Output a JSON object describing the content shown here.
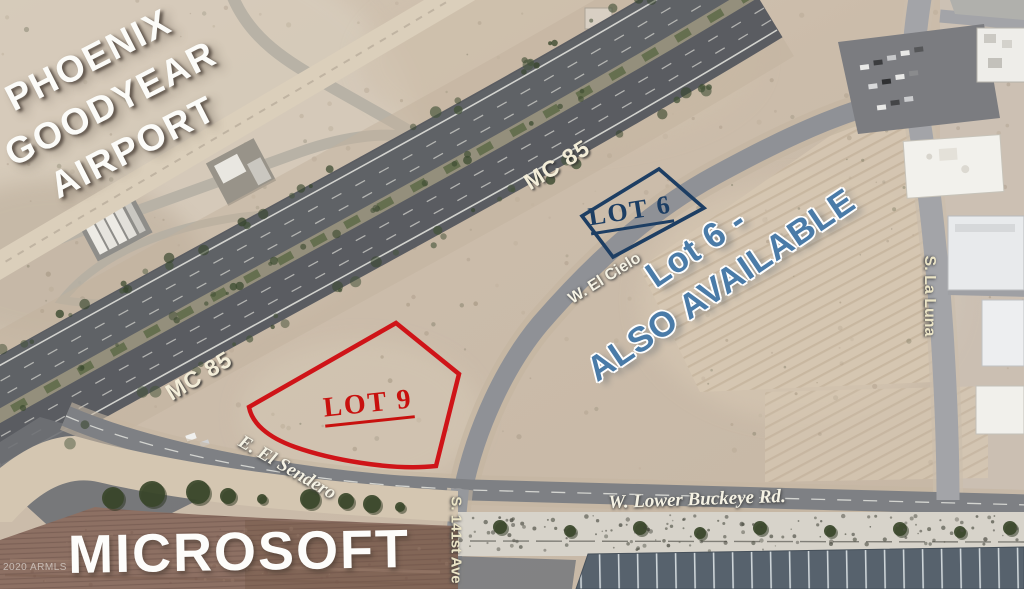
{
  "labels": {
    "airport": {
      "line1": "PHOENIX",
      "line2": "GOODYEAR",
      "line3": "AIRPORT"
    },
    "highway": {
      "upper": "MC 85",
      "lower": "MC 85"
    },
    "lot6": {
      "tag": "LOT 6",
      "callout_line1": "Lot 6 -",
      "callout_line2": "ALSO AVAILABLE"
    },
    "lot9": {
      "tag": "LOT 9"
    },
    "streets": {
      "el_cielo": "W. El Cielo",
      "el_sendero": "E. El Sendero",
      "lower_buckeye": "W. Lower Buckeye Rd.",
      "ave_141st": "S. 141st Ave",
      "la_luna": "S. La Luna"
    },
    "site": {
      "microsoft": "MICROSOFT"
    },
    "watermark": "2020 ARMLS"
  },
  "colors": {
    "lot6_outline": "#1d3e63",
    "lot9_outline": "#cf1418",
    "callout_text": "#4a7ba8",
    "highway_label": "#f3edd8",
    "street_label": "#f5f2e4",
    "airport_text": "#fcfcf9",
    "microsoft_text": "#fdfdfb"
  }
}
